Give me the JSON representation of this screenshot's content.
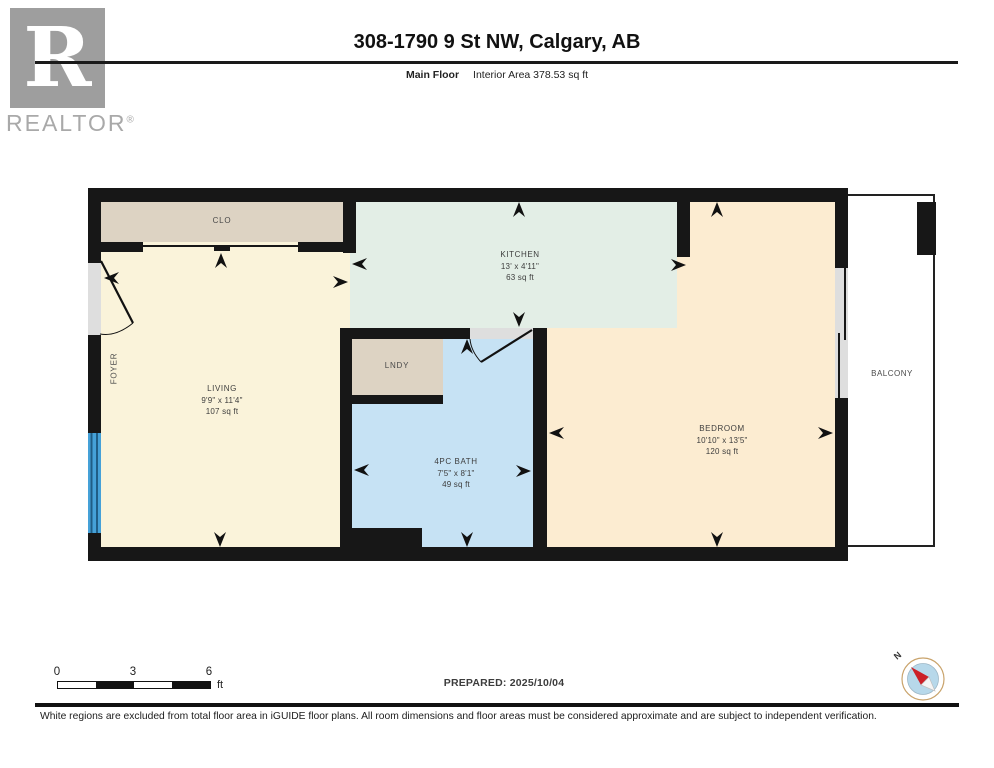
{
  "header": {
    "title": "308-1790 9 St NW, Calgary, AB",
    "floor_label": "Main Floor",
    "area_label": "Interior Area 378.53 sq ft",
    "logo_letter": "R",
    "logo_brand": "REALTOR",
    "logo_registered": "®"
  },
  "rooms": {
    "closet": {
      "name": "CLO"
    },
    "foyer": {
      "name": "FOYER"
    },
    "living": {
      "name": "LIVING",
      "dims": "9'9\" x 11'4\"",
      "area": "107 sq ft"
    },
    "kitchen": {
      "name": "KITCHEN",
      "dims": "13' x 4'11\"",
      "area": "63 sq ft"
    },
    "laundry": {
      "name": "LNDY"
    },
    "bath": {
      "name": "4PC BATH",
      "dims": "7'5\" x 8'1\"",
      "area": "49 sq ft"
    },
    "bedroom": {
      "name": "BEDROOM",
      "dims": "10'10\" x 13'5\"",
      "area": "120 sq ft"
    },
    "balcony": {
      "name": "BALCONY"
    }
  },
  "scale_bar": {
    "ticks": [
      "0",
      "3",
      "6"
    ],
    "unit": "ft"
  },
  "prepared_label": "PREPARED: 2025/10/04",
  "compass": {
    "north_label": "N"
  },
  "footer_disclaimer": "White regions are excluded from total floor area in iGUIDE floor plans. All room dimensions and floor areas must be considered approximate and are subject to independent verification.",
  "colors": {
    "wall": "#171717",
    "living": "#faf3da",
    "kitchen": "#e3eee6",
    "bedroom": "#fcecd1",
    "bath": "#c6e2f4",
    "closet_fill": "#ddd3c3",
    "window": "#45a1d8",
    "door_opening": "#dedede",
    "compass_red": "#cc2027"
  }
}
